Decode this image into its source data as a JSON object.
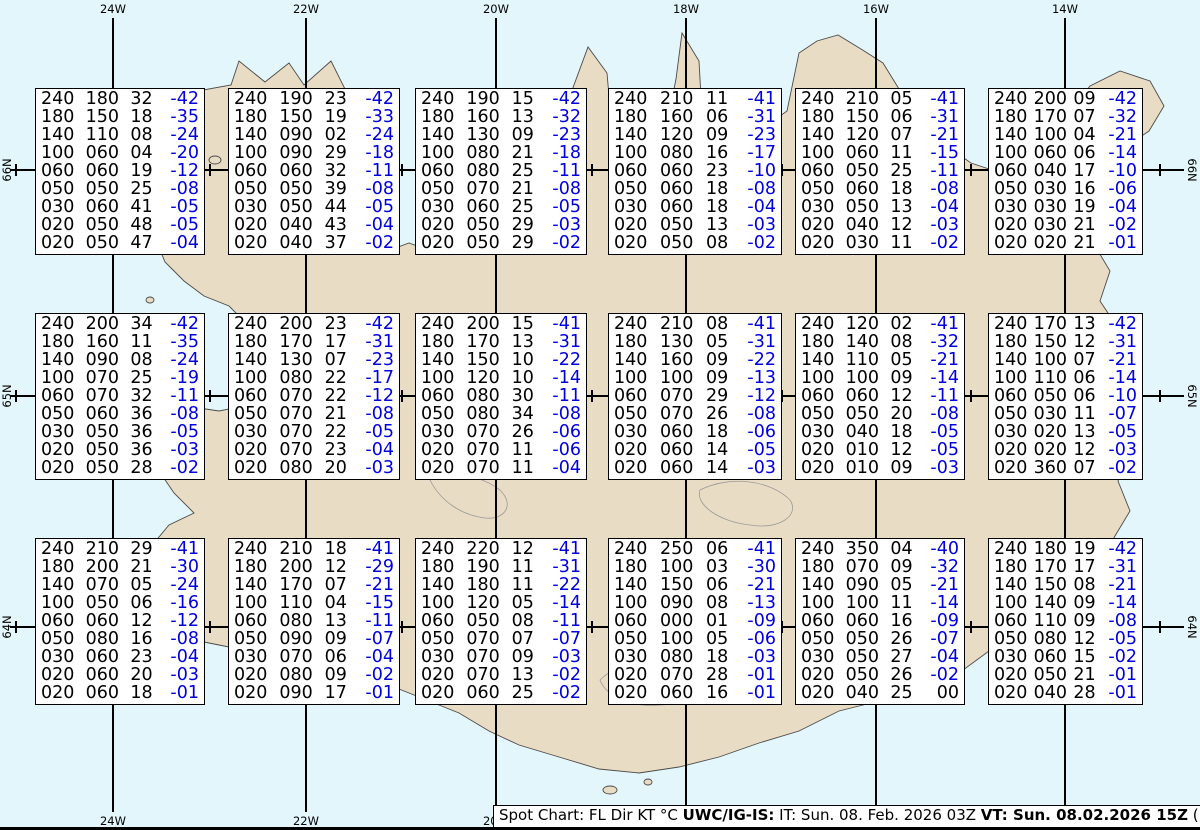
{
  "map": {
    "water_color": "#e3f6fb",
    "land_color": "#e9dcc4",
    "grid_color": "#000000",
    "longitudes": [
      {
        "label": "24W",
        "x": 113
      },
      {
        "label": "22W",
        "x": 306
      },
      {
        "label": "20W",
        "x": 496
      },
      {
        "label": "18W",
        "x": 686
      },
      {
        "label": "16W",
        "x": 876
      },
      {
        "label": "14W",
        "x": 1065
      }
    ],
    "latitudes": [
      {
        "label": "66N",
        "y": 170
      },
      {
        "label": "65N",
        "y": 396
      },
      {
        "label": "64N",
        "y": 627
      }
    ],
    "minor_crosses_x": [
      16,
      210,
      402,
      592,
      782,
      971,
      1160
    ]
  },
  "spot_boxes": {
    "columns_x": [
      35,
      228,
      415,
      608,
      795,
      988
    ],
    "col_widths": [
      170,
      172,
      172,
      174,
      170,
      155
    ],
    "rows_y": [
      88,
      313,
      538
    ],
    "box_height": 167,
    "value_color": "#000000",
    "temp_color": "#0000dd",
    "cells": [
      {
        "row": 0,
        "col": 0,
        "lines": [
          [
            "240",
            "180",
            "32",
            "-42"
          ],
          [
            "180",
            "150",
            "18",
            "-35"
          ],
          [
            "140",
            "110",
            "08",
            "-24"
          ],
          [
            "100",
            "060",
            "04",
            "-20"
          ],
          [
            "060",
            "060",
            "19",
            "-12"
          ],
          [
            "050",
            "050",
            "25",
            "-08"
          ],
          [
            "030",
            "060",
            "41",
            "-05"
          ],
          [
            "020",
            "050",
            "48",
            "-05"
          ],
          [
            "020",
            "050",
            "47",
            "-04"
          ]
        ]
      },
      {
        "row": 0,
        "col": 1,
        "lines": [
          [
            "240",
            "190",
            "23",
            "-42"
          ],
          [
            "180",
            "150",
            "19",
            "-33"
          ],
          [
            "140",
            "090",
            "02",
            "-24"
          ],
          [
            "100",
            "090",
            "29",
            "-18"
          ],
          [
            "060",
            "060",
            "32",
            "-11"
          ],
          [
            "050",
            "050",
            "39",
            "-08"
          ],
          [
            "030",
            "050",
            "44",
            "-05"
          ],
          [
            "020",
            "040",
            "43",
            "-04"
          ],
          [
            "020",
            "040",
            "37",
            "-02"
          ]
        ]
      },
      {
        "row": 0,
        "col": 2,
        "lines": [
          [
            "240",
            "190",
            "15",
            "-42"
          ],
          [
            "180",
            "160",
            "13",
            "-32"
          ],
          [
            "140",
            "130",
            "09",
            "-23"
          ],
          [
            "100",
            "080",
            "21",
            "-18"
          ],
          [
            "060",
            "080",
            "25",
            "-11"
          ],
          [
            "050",
            "070",
            "21",
            "-08"
          ],
          [
            "030",
            "060",
            "25",
            "-05"
          ],
          [
            "020",
            "050",
            "29",
            "-03"
          ],
          [
            "020",
            "050",
            "29",
            "-02"
          ]
        ]
      },
      {
        "row": 0,
        "col": 3,
        "lines": [
          [
            "240",
            "210",
            "11",
            "-41"
          ],
          [
            "180",
            "160",
            "06",
            "-31"
          ],
          [
            "140",
            "120",
            "09",
            "-23"
          ],
          [
            "100",
            "080",
            "16",
            "-17"
          ],
          [
            "060",
            "060",
            "23",
            "-10"
          ],
          [
            "050",
            "060",
            "18",
            "-08"
          ],
          [
            "030",
            "060",
            "18",
            "-04"
          ],
          [
            "020",
            "050",
            "13",
            "-03"
          ],
          [
            "020",
            "050",
            "08",
            "-02"
          ]
        ]
      },
      {
        "row": 0,
        "col": 4,
        "lines": [
          [
            "240",
            "210",
            "05",
            "-41"
          ],
          [
            "180",
            "150",
            "06",
            "-31"
          ],
          [
            "140",
            "120",
            "07",
            "-21"
          ],
          [
            "100",
            "060",
            "11",
            "-15"
          ],
          [
            "060",
            "050",
            "25",
            "-11"
          ],
          [
            "050",
            "060",
            "18",
            "-08"
          ],
          [
            "030",
            "050",
            "13",
            "-04"
          ],
          [
            "020",
            "040",
            "12",
            "-03"
          ],
          [
            "020",
            "030",
            "11",
            "-02"
          ]
        ]
      },
      {
        "row": 0,
        "col": 5,
        "lines": [
          [
            "240",
            "200",
            "09",
            "-42"
          ],
          [
            "180",
            "170",
            "07",
            "-32"
          ],
          [
            "140",
            "100",
            "04",
            "-21"
          ],
          [
            "100",
            "060",
            "06",
            "-14"
          ],
          [
            "060",
            "040",
            "17",
            "-10"
          ],
          [
            "050",
            "030",
            "16",
            "-06"
          ],
          [
            "030",
            "030",
            "19",
            "-04"
          ],
          [
            "020",
            "030",
            "21",
            "-02"
          ],
          [
            "020",
            "020",
            "21",
            "-01"
          ]
        ]
      },
      {
        "row": 1,
        "col": 0,
        "lines": [
          [
            "240",
            "200",
            "34",
            "-42"
          ],
          [
            "180",
            "160",
            "11",
            "-35"
          ],
          [
            "140",
            "090",
            "08",
            "-24"
          ],
          [
            "100",
            "070",
            "25",
            "-19"
          ],
          [
            "060",
            "070",
            "32",
            "-11"
          ],
          [
            "050",
            "060",
            "36",
            "-08"
          ],
          [
            "030",
            "050",
            "36",
            "-05"
          ],
          [
            "020",
            "050",
            "36",
            "-03"
          ],
          [
            "020",
            "050",
            "28",
            "-02"
          ]
        ]
      },
      {
        "row": 1,
        "col": 1,
        "lines": [
          [
            "240",
            "200",
            "23",
            "-42"
          ],
          [
            "180",
            "170",
            "17",
            "-31"
          ],
          [
            "140",
            "130",
            "07",
            "-23"
          ],
          [
            "100",
            "080",
            "22",
            "-17"
          ],
          [
            "060",
            "070",
            "22",
            "-12"
          ],
          [
            "050",
            "070",
            "21",
            "-08"
          ],
          [
            "030",
            "070",
            "22",
            "-05"
          ],
          [
            "020",
            "070",
            "23",
            "-04"
          ],
          [
            "020",
            "080",
            "20",
            "-03"
          ]
        ]
      },
      {
        "row": 1,
        "col": 2,
        "lines": [
          [
            "240",
            "200",
            "15",
            "-41"
          ],
          [
            "180",
            "170",
            "13",
            "-31"
          ],
          [
            "140",
            "150",
            "10",
            "-22"
          ],
          [
            "100",
            "120",
            "10",
            "-14"
          ],
          [
            "060",
            "080",
            "30",
            "-11"
          ],
          [
            "050",
            "080",
            "34",
            "-08"
          ],
          [
            "030",
            "070",
            "26",
            "-06"
          ],
          [
            "020",
            "070",
            "11",
            "-06"
          ],
          [
            "020",
            "070",
            "11",
            "-04"
          ]
        ]
      },
      {
        "row": 1,
        "col": 3,
        "lines": [
          [
            "240",
            "210",
            "08",
            "-41"
          ],
          [
            "180",
            "130",
            "05",
            "-31"
          ],
          [
            "140",
            "160",
            "09",
            "-22"
          ],
          [
            "100",
            "100",
            "09",
            "-13"
          ],
          [
            "060",
            "070",
            "29",
            "-12"
          ],
          [
            "050",
            "070",
            "26",
            "-08"
          ],
          [
            "030",
            "060",
            "18",
            "-06"
          ],
          [
            "020",
            "060",
            "14",
            "-05"
          ],
          [
            "020",
            "060",
            "14",
            "-03"
          ]
        ]
      },
      {
        "row": 1,
        "col": 4,
        "lines": [
          [
            "240",
            "120",
            "02",
            "-41"
          ],
          [
            "180",
            "140",
            "08",
            "-32"
          ],
          [
            "140",
            "110",
            "05",
            "-21"
          ],
          [
            "100",
            "100",
            "09",
            "-14"
          ],
          [
            "060",
            "060",
            "12",
            "-11"
          ],
          [
            "050",
            "050",
            "20",
            "-08"
          ],
          [
            "030",
            "040",
            "18",
            "-05"
          ],
          [
            "020",
            "010",
            "12",
            "-05"
          ],
          [
            "020",
            "010",
            "09",
            "-03"
          ]
        ]
      },
      {
        "row": 1,
        "col": 5,
        "lines": [
          [
            "240",
            "170",
            "13",
            "-42"
          ],
          [
            "180",
            "150",
            "12",
            "-31"
          ],
          [
            "140",
            "100",
            "07",
            "-21"
          ],
          [
            "100",
            "110",
            "06",
            "-14"
          ],
          [
            "060",
            "050",
            "06",
            "-10"
          ],
          [
            "050",
            "030",
            "11",
            "-07"
          ],
          [
            "030",
            "020",
            "13",
            "-05"
          ],
          [
            "020",
            "020",
            "12",
            "-03"
          ],
          [
            "020",
            "360",
            "07",
            "-02"
          ]
        ]
      },
      {
        "row": 2,
        "col": 0,
        "lines": [
          [
            "240",
            "210",
            "29",
            "-41"
          ],
          [
            "180",
            "200",
            "21",
            "-30"
          ],
          [
            "140",
            "070",
            "05",
            "-24"
          ],
          [
            "100",
            "050",
            "06",
            "-16"
          ],
          [
            "060",
            "060",
            "12",
            "-12"
          ],
          [
            "050",
            "080",
            "16",
            "-08"
          ],
          [
            "030",
            "060",
            "23",
            "-04"
          ],
          [
            "020",
            "060",
            "20",
            "-03"
          ],
          [
            "020",
            "060",
            "18",
            "-01"
          ]
        ]
      },
      {
        "row": 2,
        "col": 1,
        "lines": [
          [
            "240",
            "210",
            "18",
            "-41"
          ],
          [
            "180",
            "200",
            "12",
            "-29"
          ],
          [
            "140",
            "170",
            "07",
            "-21"
          ],
          [
            "100",
            "110",
            "04",
            "-15"
          ],
          [
            "060",
            "080",
            "13",
            "-11"
          ],
          [
            "050",
            "090",
            "09",
            "-07"
          ],
          [
            "030",
            "070",
            "06",
            "-04"
          ],
          [
            "020",
            "080",
            "09",
            "-02"
          ],
          [
            "020",
            "090",
            "17",
            "-01"
          ]
        ]
      },
      {
        "row": 2,
        "col": 2,
        "lines": [
          [
            "240",
            "220",
            "12",
            "-41"
          ],
          [
            "180",
            "190",
            "11",
            "-31"
          ],
          [
            "140",
            "180",
            "11",
            "-22"
          ],
          [
            "100",
            "120",
            "05",
            "-14"
          ],
          [
            "060",
            "050",
            "08",
            "-11"
          ],
          [
            "050",
            "070",
            "07",
            "-07"
          ],
          [
            "030",
            "070",
            "09",
            "-03"
          ],
          [
            "020",
            "070",
            "13",
            "-02"
          ],
          [
            "020",
            "060",
            "25",
            "-02"
          ]
        ]
      },
      {
        "row": 2,
        "col": 3,
        "lines": [
          [
            "240",
            "250",
            "06",
            "-41"
          ],
          [
            "180",
            "100",
            "03",
            "-30"
          ],
          [
            "140",
            "150",
            "06",
            "-21"
          ],
          [
            "100",
            "090",
            "08",
            "-13"
          ],
          [
            "060",
            "000",
            "01",
            "-09"
          ],
          [
            "050",
            "100",
            "05",
            "-06"
          ],
          [
            "030",
            "080",
            "18",
            "-03"
          ],
          [
            "020",
            "070",
            "28",
            "-01"
          ],
          [
            "020",
            "060",
            "16",
            "-01"
          ]
        ]
      },
      {
        "row": 2,
        "col": 4,
        "lines": [
          [
            "240",
            "350",
            "04",
            "-40"
          ],
          [
            "180",
            "070",
            "09",
            "-32"
          ],
          [
            "140",
            "090",
            "05",
            "-21"
          ],
          [
            "100",
            "100",
            "11",
            "-14"
          ],
          [
            "060",
            "060",
            "16",
            "-09"
          ],
          [
            "050",
            "050",
            "26",
            "-07"
          ],
          [
            "030",
            "050",
            "27",
            "-04"
          ],
          [
            "020",
            "050",
            "26",
            "-02"
          ],
          [
            "020",
            "040",
            "25",
            "00"
          ]
        ]
      },
      {
        "row": 2,
        "col": 5,
        "lines": [
          [
            "240",
            "180",
            "19",
            "-42"
          ],
          [
            "180",
            "170",
            "17",
            "-31"
          ],
          [
            "140",
            "150",
            "08",
            "-21"
          ],
          [
            "100",
            "140",
            "09",
            "-14"
          ],
          [
            "060",
            "110",
            "09",
            "-08"
          ],
          [
            "050",
            "080",
            "12",
            "-05"
          ],
          [
            "030",
            "060",
            "15",
            "-02"
          ],
          [
            "020",
            "050",
            "21",
            "-01"
          ],
          [
            "020",
            "040",
            "28",
            "-01"
          ]
        ]
      }
    ]
  },
  "footer": {
    "prefix": "Spot Chart: FL Dir KT °C ",
    "product": "UWC/IG-IS:",
    "issue": " IT: Sun. 08. Feb. 2026 03Z ",
    "valid": "VT: Sun. 08.02.2026 15Z",
    "suffix": " (+12 h)"
  }
}
